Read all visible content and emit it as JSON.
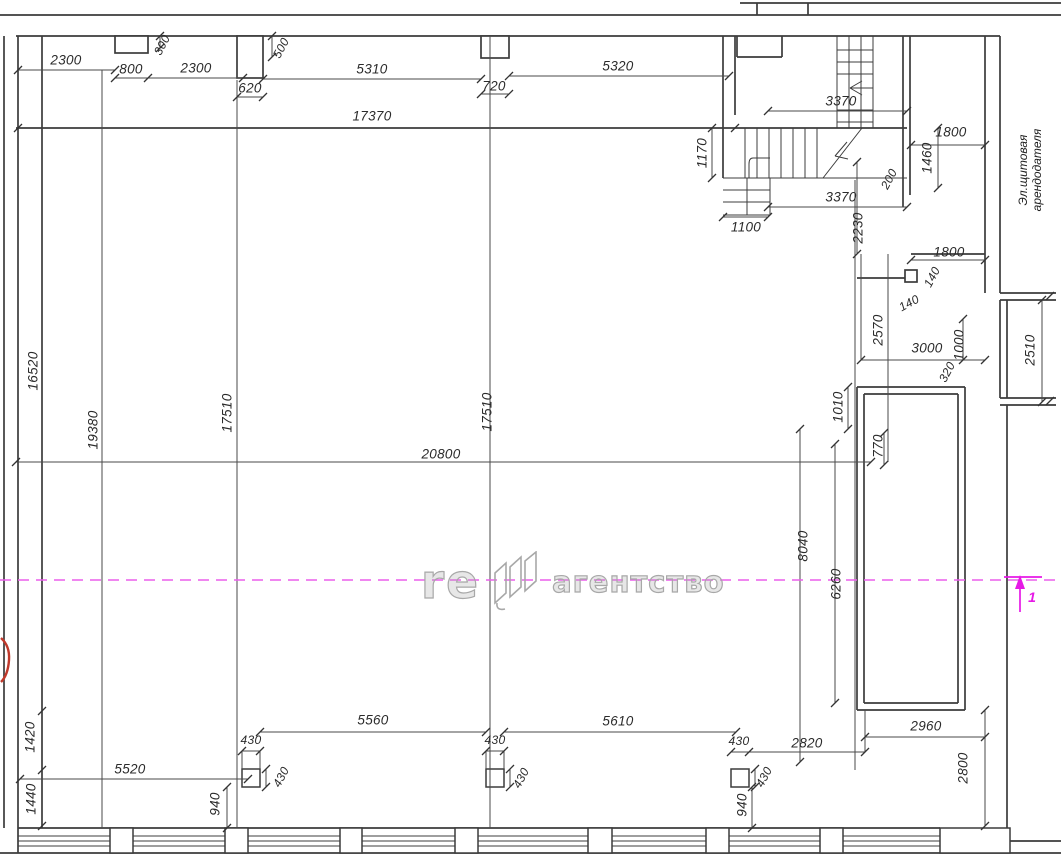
{
  "watermark": {
    "part1": "re",
    "part2": "агентство"
  },
  "labels": {
    "electrical_room_line1": "Эл.щитовая",
    "electrical_room_line2": "арендодателя",
    "section_mark_sub": "1"
  },
  "dims": {
    "top": [
      "2300",
      "800",
      "300",
      "2300",
      "620",
      "500",
      "5310",
      "720",
      "5320",
      "17370"
    ],
    "stair": [
      "3370",
      "1170",
      "1800",
      "1460",
      "200",
      "3370",
      "2230",
      "1100"
    ],
    "right": [
      "1800",
      "140",
      "140",
      "2570",
      "3000",
      "1000",
      "320",
      "2510",
      "1010",
      "770",
      "8040",
      "6260"
    ],
    "left": [
      "16520",
      "19380",
      "17510",
      "17510",
      "20800"
    ],
    "bottom": [
      "5560",
      "430",
      "430",
      "430",
      "430",
      "5610",
      "430",
      "430",
      "2820",
      "2960",
      "2800",
      "1420",
      "1440",
      "5520",
      "940",
      "940"
    ]
  }
}
